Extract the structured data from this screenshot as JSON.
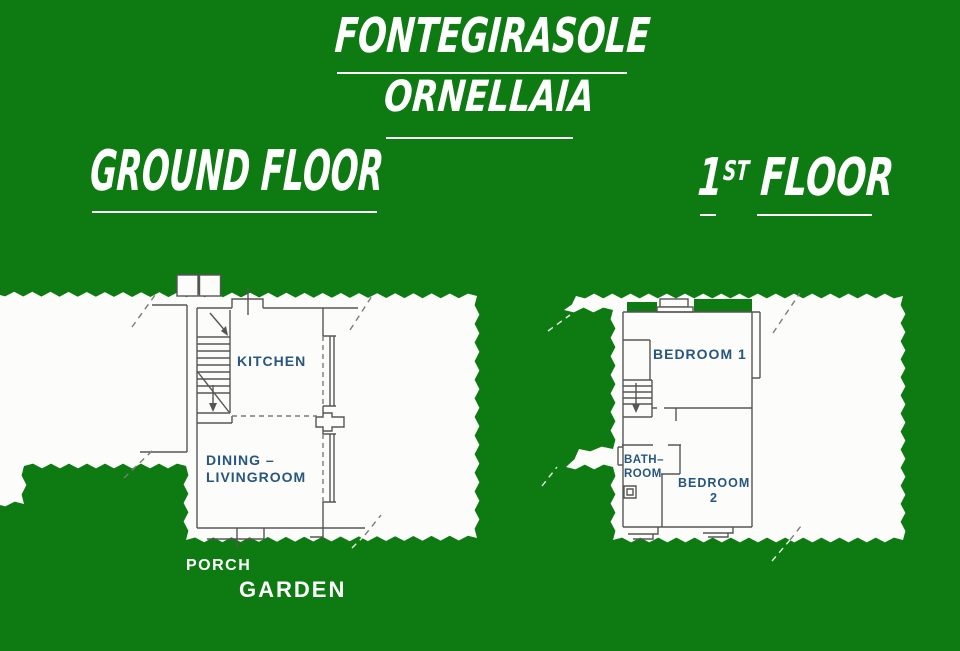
{
  "page": {
    "width": 960,
    "height": 651
  },
  "header": {
    "property_name": "FONTEGIRASOLE",
    "property_subname": "ORNELLAIA"
  },
  "ground_floor": {
    "heading": "GROUND FLOOR",
    "labels": {
      "kitchen": "KITCHEN",
      "dining_line1": "DINING –",
      "dining_line2": "LIVINGROOM",
      "porch": "PORCH",
      "garden": "GARDEN"
    }
  },
  "first_floor": {
    "heading_number": "1",
    "heading_ordinal": "ST",
    "heading_word": "FLOOR",
    "labels": {
      "bedroom1": "BEDROOM 1",
      "bathroom_line1": "BATH–",
      "bathroom_line2": "ROOM",
      "bedroom2_line1": "BEDROOM",
      "bedroom2_line2": "2"
    }
  },
  "colors": {
    "background_green": "#0d7a12",
    "paper_white": "#fcfcfa",
    "plan_line_gray": "#565656",
    "room_label_blue": "#27567e",
    "heading_white": "#ffffff"
  }
}
